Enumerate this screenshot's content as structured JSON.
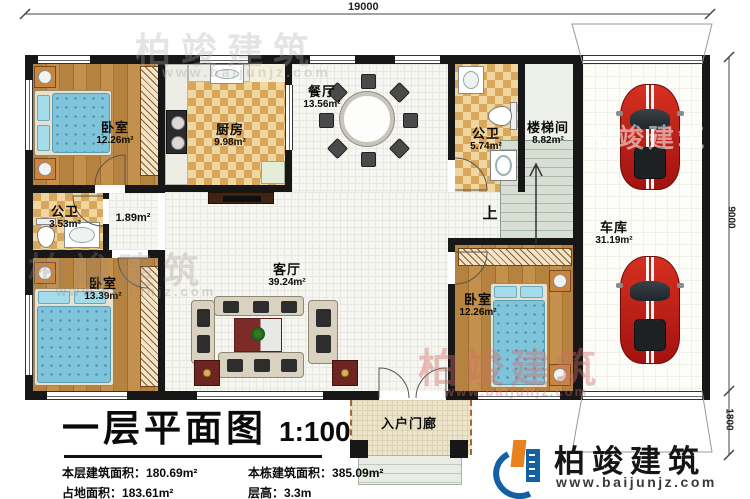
{
  "dimensions": {
    "top": "19000",
    "right_main": "9000",
    "right_lower": "1800"
  },
  "rooms": {
    "bedroom_tl": {
      "name": "卧室",
      "area": "12.26m²"
    },
    "kitchen": {
      "name": "厨房",
      "area": "9.98m²"
    },
    "dining": {
      "name": "餐厅",
      "area": "13.56m²"
    },
    "bath_top": {
      "name": "公卫",
      "area": "5.74m²"
    },
    "stairwell": {
      "name": "楼梯间",
      "area": "8.82m²"
    },
    "garage": {
      "name": "车库",
      "area": "31.19m²"
    },
    "bath_left": {
      "name": "公卫",
      "area": "3.53m²"
    },
    "hallway": {
      "area": "1.89m²"
    },
    "bedroom_bl": {
      "name": "卧室",
      "area": "13.39m²"
    },
    "living": {
      "name": "客厅",
      "area": "39.24m²"
    },
    "bedroom_br": {
      "name": "卧室",
      "area": "12.26m²"
    },
    "porch": {
      "name": "入户门廊"
    },
    "stairs_up": "上"
  },
  "title_block": {
    "title": "一层平面图",
    "scale": "1:100",
    "stats": [
      {
        "label": "本层建筑面积：",
        "value": "180.69m²"
      },
      {
        "label": "本栋建筑面积：",
        "value": "385.09m²"
      },
      {
        "label": "占地面积：",
        "value": "183.61m²"
      },
      {
        "label": "层高：",
        "value": "3.3m"
      }
    ]
  },
  "branding": {
    "brand": "柏竣建筑",
    "url": "www.baijunjz.com"
  },
  "colors": {
    "wall": "#171717",
    "wood": "#b6823f",
    "check_light": "#f0d7a0",
    "check_dark": "#d9a75c",
    "car_red": "#c81e1e",
    "stair_green": "#d7dfd5",
    "accent_blue": "#1460a4",
    "accent_orange": "#e8821e"
  }
}
